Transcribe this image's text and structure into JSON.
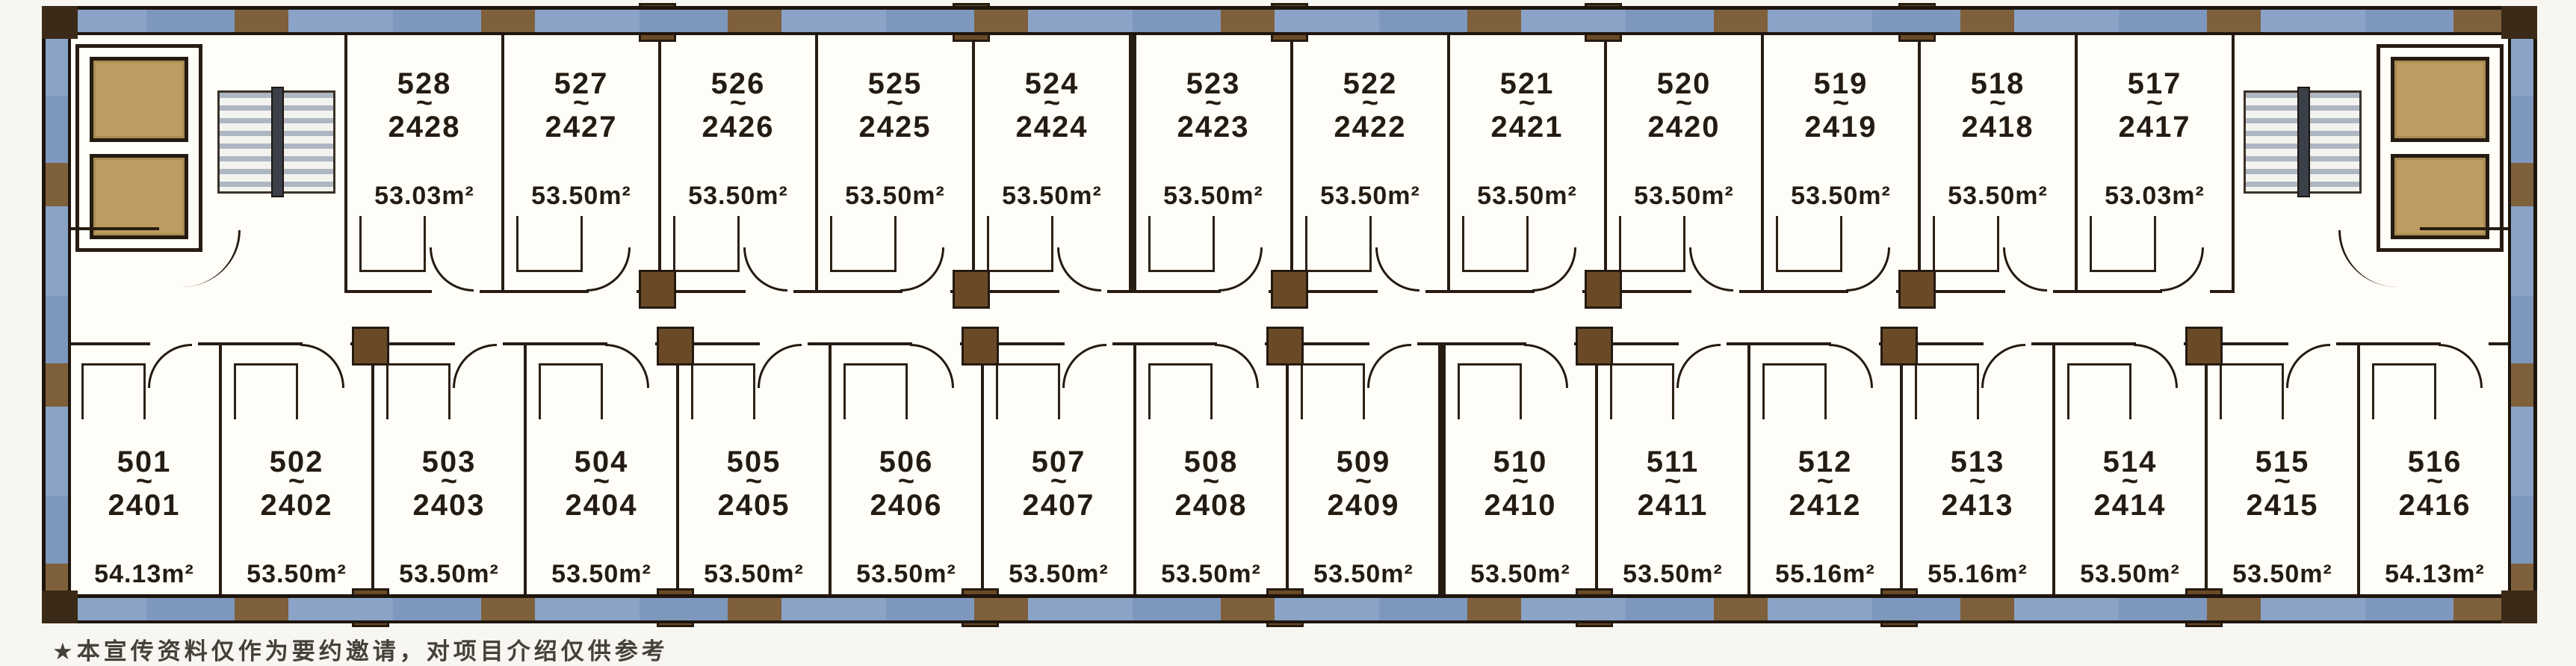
{
  "plan": {
    "type": "hotel-floor-plan",
    "corridor": "double-loaded central corridor",
    "cores": {
      "left": {
        "elevators": 2,
        "stairs": true
      },
      "right": {
        "elevators": 2,
        "stairs": true
      }
    }
  },
  "labels": {
    "tilde": "~",
    "area_unit": "m²"
  },
  "colors": {
    "wall": "#271c11",
    "column": "#6a4a26",
    "elevator_fill": "#bc9c61",
    "band_blue": "#8aa3c7",
    "band_brown": "#7e603b",
    "stair_tread": "#aeb6c2",
    "paper": "#fffdf7",
    "text": "#241c12"
  },
  "rooms_top": [
    {
      "unit": "528",
      "alt": "2428",
      "area": "53.03"
    },
    {
      "unit": "527",
      "alt": "2427",
      "area": "53.50"
    },
    {
      "unit": "526",
      "alt": "2426",
      "area": "53.50"
    },
    {
      "unit": "525",
      "alt": "2425",
      "area": "53.50"
    },
    {
      "unit": "524",
      "alt": "2424",
      "area": "53.50"
    },
    {
      "unit": "523",
      "alt": "2423",
      "area": "53.50"
    },
    {
      "unit": "522",
      "alt": "2422",
      "area": "53.50"
    },
    {
      "unit": "521",
      "alt": "2421",
      "area": "53.50"
    },
    {
      "unit": "520",
      "alt": "2420",
      "area": "53.50"
    },
    {
      "unit": "519",
      "alt": "2419",
      "area": "53.50"
    },
    {
      "unit": "518",
      "alt": "2418",
      "area": "53.50"
    },
    {
      "unit": "517",
      "alt": "2417",
      "area": "53.03"
    }
  ],
  "rooms_bottom": [
    {
      "unit": "501",
      "alt": "2401",
      "area": "54.13"
    },
    {
      "unit": "502",
      "alt": "2402",
      "area": "53.50"
    },
    {
      "unit": "503",
      "alt": "2403",
      "area": "53.50"
    },
    {
      "unit": "504",
      "alt": "2404",
      "area": "53.50"
    },
    {
      "unit": "505",
      "alt": "2405",
      "area": "53.50"
    },
    {
      "unit": "506",
      "alt": "2406",
      "area": "53.50"
    },
    {
      "unit": "507",
      "alt": "2407",
      "area": "53.50"
    },
    {
      "unit": "508",
      "alt": "2408",
      "area": "53.50"
    },
    {
      "unit": "509",
      "alt": "2409",
      "area": "53.50"
    },
    {
      "unit": "510",
      "alt": "2410",
      "area": "53.50"
    },
    {
      "unit": "511",
      "alt": "2411",
      "area": "53.50"
    },
    {
      "unit": "512",
      "alt": "2412",
      "area": "55.16"
    },
    {
      "unit": "513",
      "alt": "2413",
      "area": "55.16"
    },
    {
      "unit": "514",
      "alt": "2414",
      "area": "53.50"
    },
    {
      "unit": "515",
      "alt": "2415",
      "area": "53.50"
    },
    {
      "unit": "516",
      "alt": "2416",
      "area": "54.13"
    }
  ],
  "footnote": {
    "bullet": "★",
    "text": "本宣传资料仅作为要约邀请，对项目介绍仅供参考"
  }
}
